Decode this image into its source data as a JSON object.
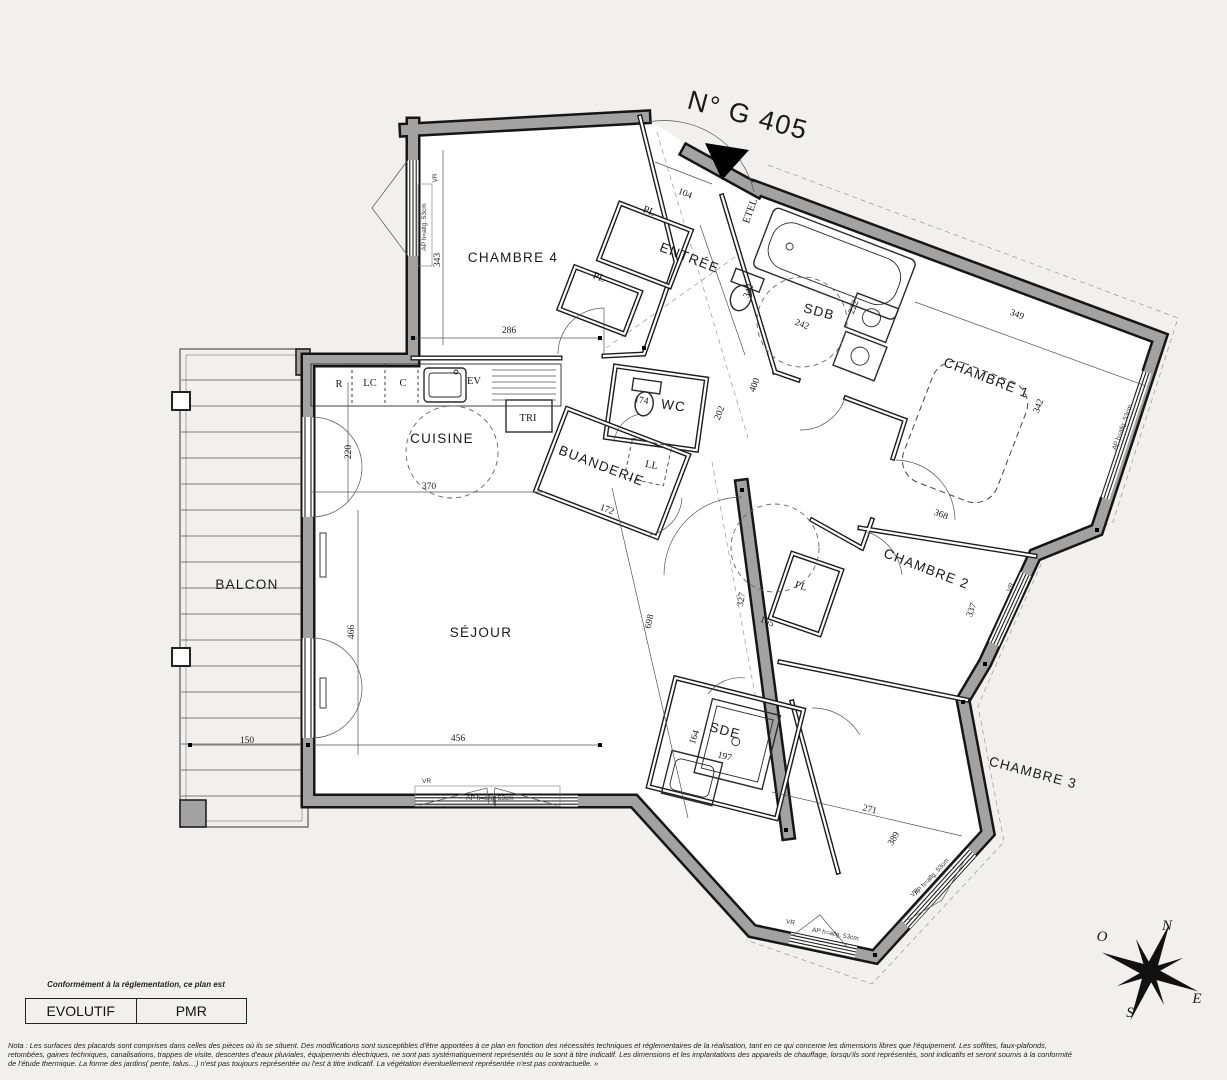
{
  "plan": {
    "title": "N° G 405",
    "rooms": [
      {
        "name": "CHAMBRE 4"
      },
      {
        "name": "ENTRÉE"
      },
      {
        "name": "SDB"
      },
      {
        "name": "CHAMBRE 1"
      },
      {
        "name": "CUISINE"
      },
      {
        "name": "BUANDERIE"
      },
      {
        "name": "WC"
      },
      {
        "name": "SÉJOUR"
      },
      {
        "name": "BALCON"
      },
      {
        "name": "CHAMBRE 2"
      },
      {
        "name": "SDE"
      },
      {
        "name": "CHAMBRE 3"
      }
    ],
    "fixtures": [
      "R",
      "LC",
      "C",
      "EV",
      "TRI",
      "LL",
      "ETEL",
      "PL",
      "PL",
      "PL"
    ],
    "window_labels": {
      "vr": "VR",
      "ap": "AP h=allg. 53cm"
    },
    "dimensions_cm": [
      "343",
      "286",
      "104",
      "342",
      "222",
      "242",
      "400",
      "202",
      "174",
      "172",
      "220",
      "370",
      "466",
      "456",
      "150",
      "698",
      "349",
      "342",
      "368",
      "337",
      "327",
      "165",
      "164",
      "197",
      "271",
      "389"
    ],
    "compass": {
      "n": "N",
      "s": "S",
      "e": "E",
      "o": "O"
    }
  },
  "legend": {
    "caption": "Conformément à la réglementation, ce plan est",
    "boxes": [
      {
        "label": "EVOLUTIF"
      },
      {
        "label": "PMR"
      }
    ]
  },
  "nota": {
    "line1": "Nota : Les surfaces des placards sont comprises dans celles des pièces où ils se situent. Des modifications sont susceptibles d'être apportées à ce plan en fonction des nécessités techniques et réglementaires de la réalisation, tant en ce qui concerne les dimensions libres que l'équipement.  Les soffites, faux-plafonds,",
    "line2": "retombées, gaines techniques, canalisations, trappes de visite, descentes d'eaux pluviales, équipements électriques, ne sont pas systématiquement représentés ou le sont à titre indicatif. Les dimensions et les implantations des appareils de chauffage, lorsqu'ils sont représentés, sont indicatifs et seront soumis à la conformité",
    "line3": "de l'étude thermique. La forme des jardins( pente, talus…) n'est pas toujours représentée ou l'est à titre indicatif. La végétation éventuellement représentée n'est pas contractuelle. »"
  }
}
